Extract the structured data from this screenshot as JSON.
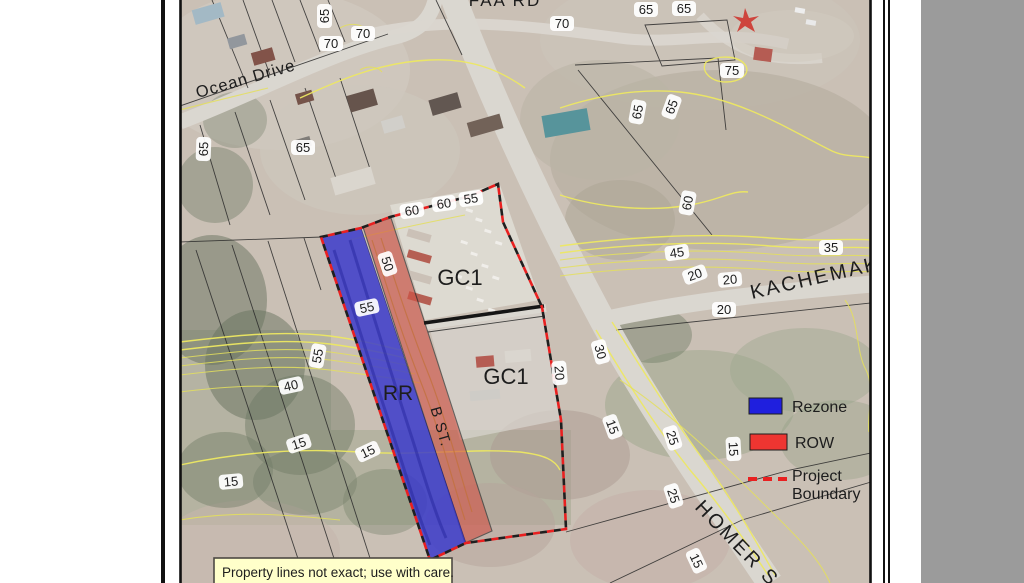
{
  "map": {
    "streets": {
      "top": "FAA RD",
      "ocean": "Ocean Drive",
      "kachemak": "KACHEMAK",
      "homer": "HOMER S"
    },
    "zones": {
      "gc1_upper": "GC1",
      "gc1_lower": "GC1",
      "rr": "RR",
      "b_street": "B ST."
    },
    "contour_labels": [
      "65",
      "70",
      "70",
      "70",
      "65",
      "65",
      "75",
      "65",
      "65",
      "60",
      "65",
      "65",
      "60",
      "60",
      "55",
      "50",
      "55",
      "55",
      "40",
      "15",
      "15",
      "15",
      "45",
      "35",
      "20",
      "20",
      "20",
      "30",
      "20",
      "15",
      "25",
      "15",
      "25",
      "15"
    ],
    "legend": {
      "rezone_label": "Rezone",
      "row_label": "ROW",
      "boundary_label_line1": "Project",
      "boundary_label_line2": "Boundary",
      "rezone_color": "#1414dd",
      "row_color": "#ee2b26",
      "boundary_color": "#e81515"
    },
    "note": "Property lines not exact; use with care.",
    "colors": {
      "contour": "#ece75a",
      "rezone_fill": "#2d2dcb",
      "row_fill": "#cf4a3d",
      "boundary_red": "#e81515",
      "photo_base": "#c8bdb2"
    }
  }
}
